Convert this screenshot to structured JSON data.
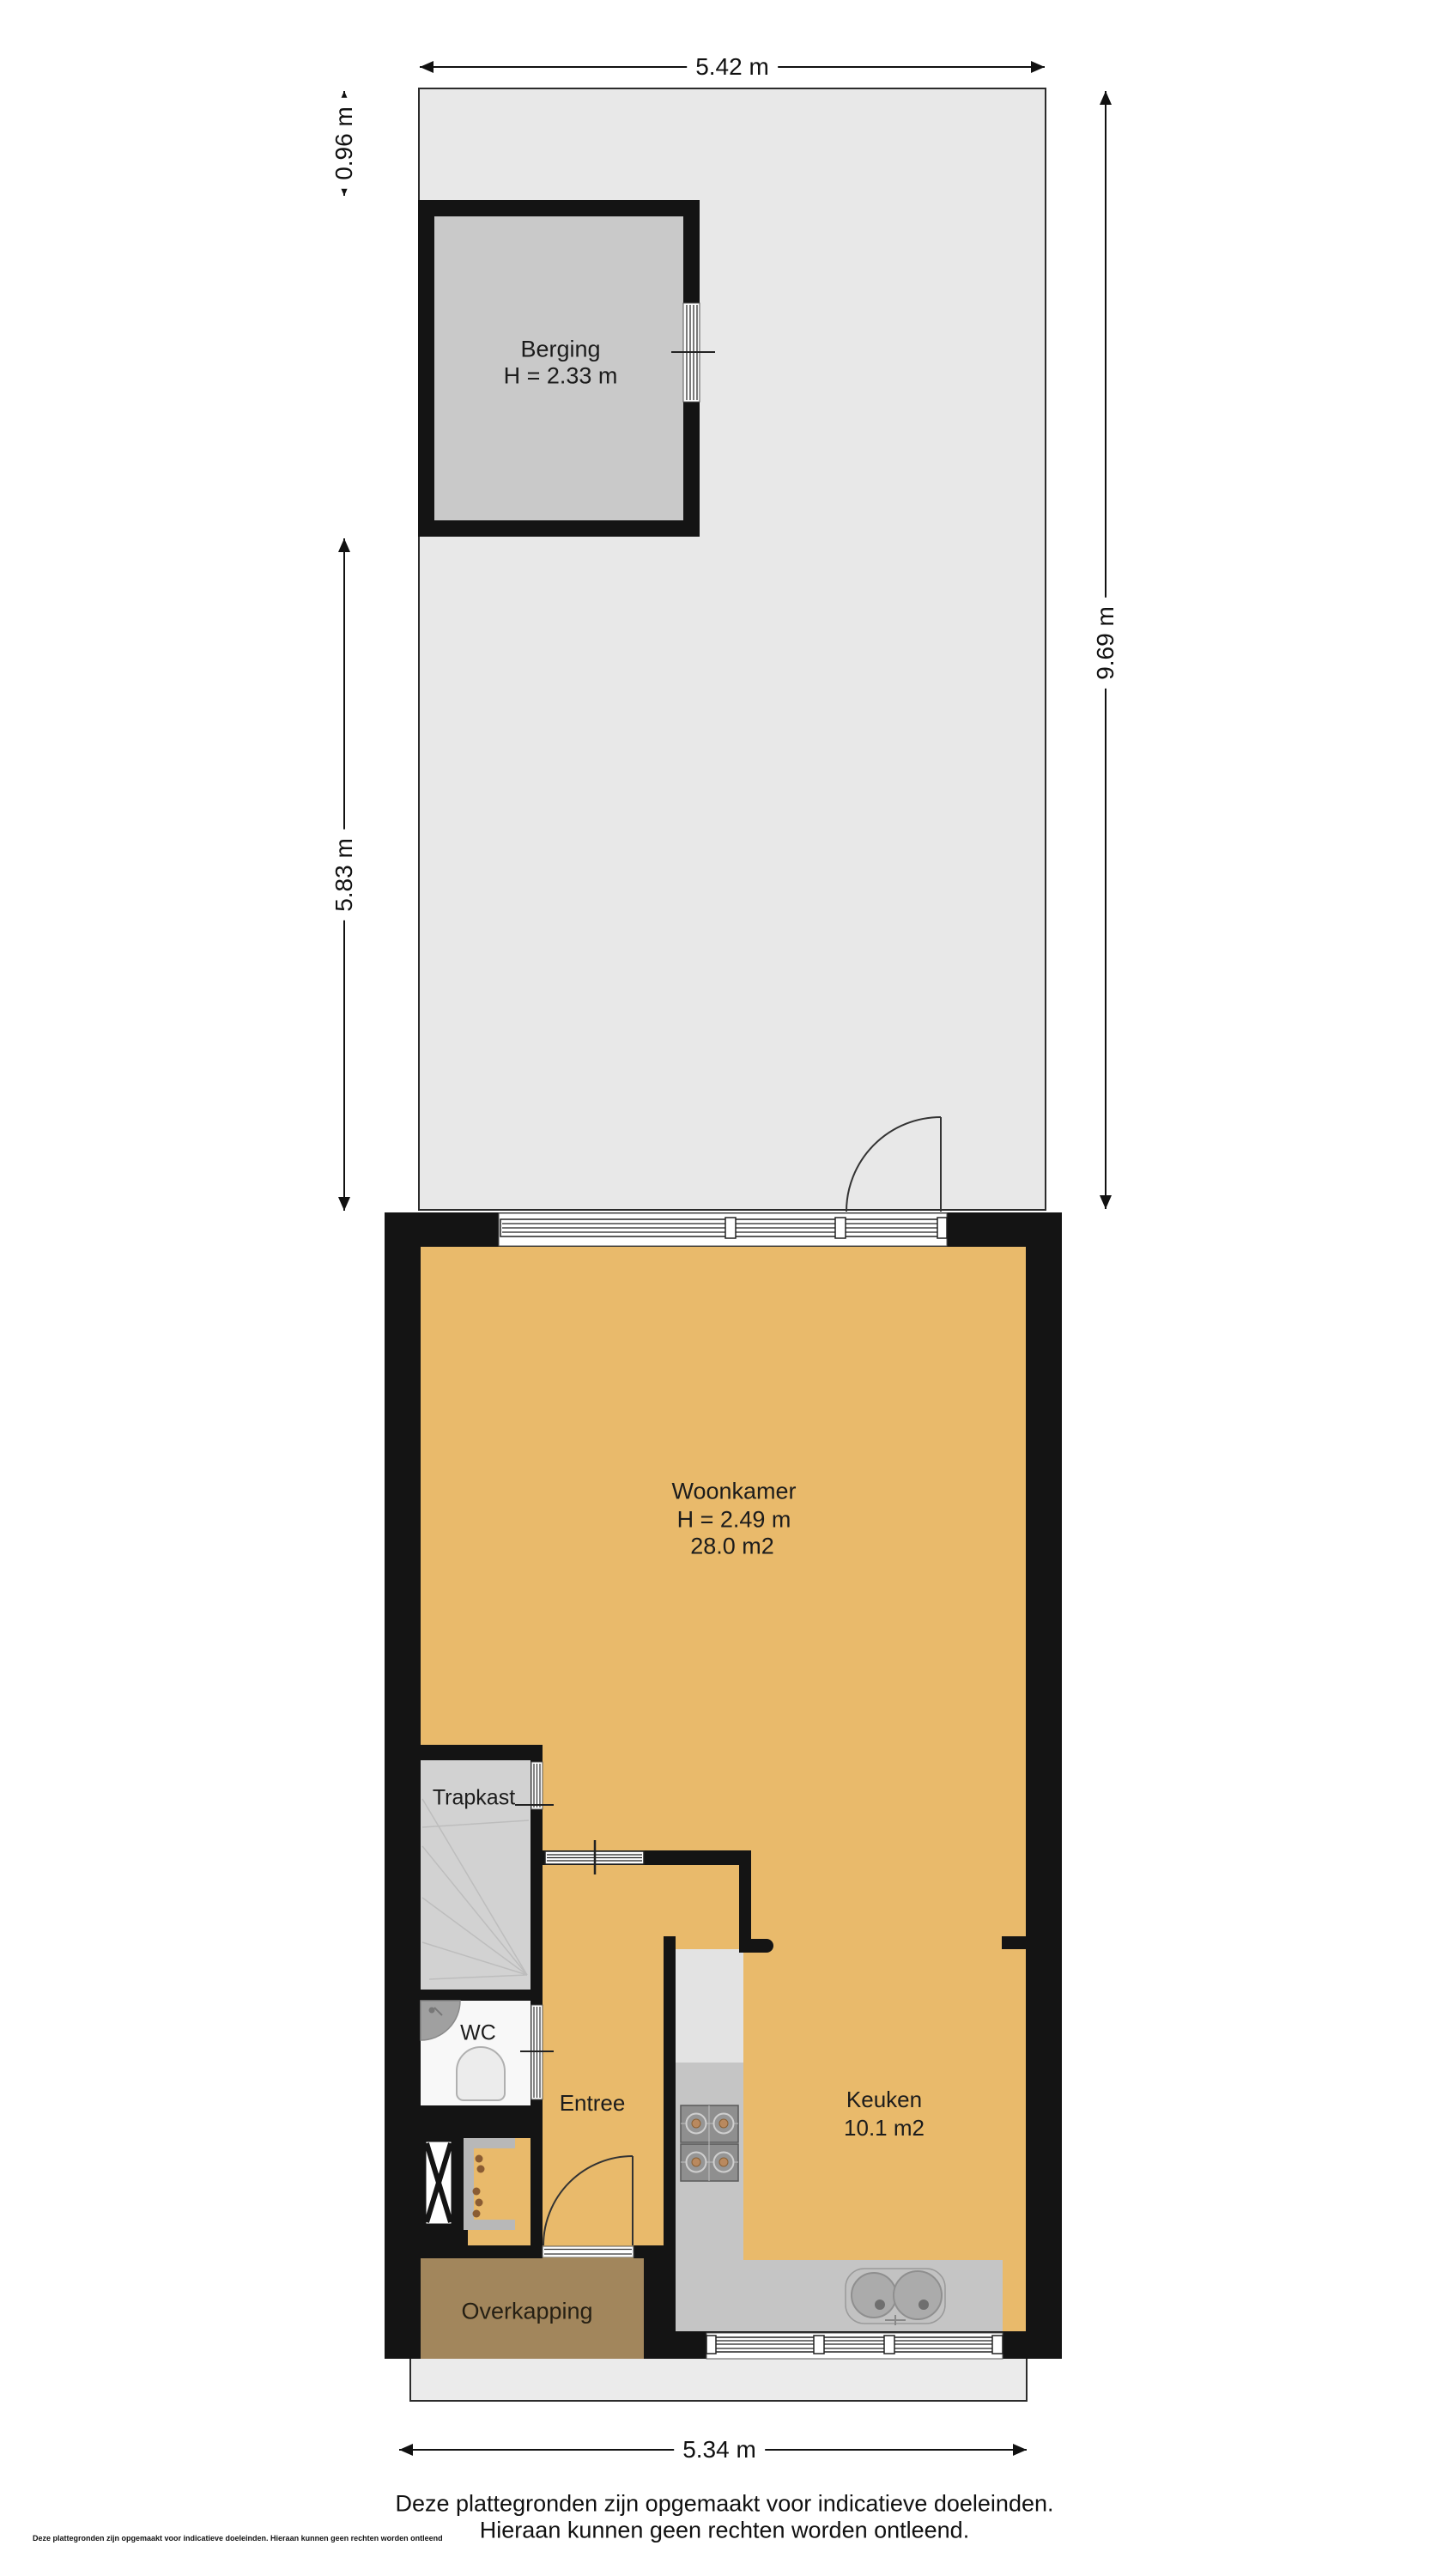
{
  "rooms": {
    "berging": {
      "name": "Berging",
      "height": "H = 2.33 m"
    },
    "woonkamer": {
      "name": "Woonkamer",
      "height": "H = 2.49 m",
      "area": "28.0 m2"
    },
    "trapkast": {
      "name": "Trapkast"
    },
    "wc": {
      "name": "WC"
    },
    "entree": {
      "name": "Entree"
    },
    "keuken": {
      "name": "Keuken",
      "area": "10.1 m2"
    },
    "overkapping": {
      "name": "Overkapping"
    }
  },
  "dimensions": {
    "top": "5.42 m",
    "left_upper": "0.96 m",
    "left_lower": "5.83 m",
    "right": "9.69 m",
    "bottom": "5.34 m"
  },
  "footer": {
    "line1": "Deze plattegronden zijn opgemaakt voor indicatieve doeleinden.",
    "line2": "Hieraan kunnen geen rechten worden ontleend.",
    "fine_print": "Deze plattegronden zijn opgemaakt voor indicatieve doeleinden. Hieraan kunnen geen rechten worden ontleend"
  },
  "colors": {
    "wall": "#141414",
    "floor_orange": "#e9ba6b",
    "garden": "#e8e8e8",
    "berging_floor": "#c9c9c9",
    "stairs": "#d2d2d2",
    "wc_floor": "#f8f8f8",
    "counter_light": "#e3e3e3",
    "counter": "#c5c5c5",
    "overkapping": "#a2865c",
    "pavement": "#ebebeb",
    "line": "#111111"
  }
}
